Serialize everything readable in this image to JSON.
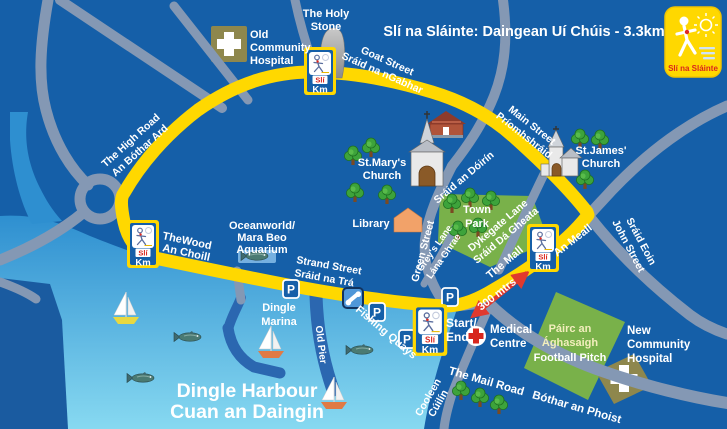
{
  "title": "Slí na Sláinte: Daingean Uí Chúis - 3.3km",
  "logo": {
    "name": "Slí na Sláinte"
  },
  "km_marker": {
    "sli": "Slí",
    "km": "Km"
  },
  "icons": {
    "parking": "P"
  },
  "scale": {
    "distance": "300 mtrs"
  },
  "colors": {
    "route_yellow": "#ffd800",
    "land_blue": "#155fa8",
    "road_gray": "#8498b4",
    "sea_top": "#2e8fd0",
    "sea_bottom": "#87d9f1",
    "arrow_red": "#e0392e",
    "park_green": "#79b14a",
    "hospital_khaki": "#8e874d"
  },
  "labels": {
    "holy_stone": {
      "l1": "The Holy",
      "l2": "Stone"
    },
    "old_hospital": {
      "l1": "Old",
      "l2": "Community",
      "l3": "Hospital"
    },
    "goat_street": {
      "l1": "Goat Street",
      "l2": "Sráid na nGabhar"
    },
    "high_road": {
      "l1": "The High Road",
      "l2": "An Bóthar Ard"
    },
    "main_street": {
      "l1": "Main Street",
      "l2": "Príomhshráid"
    },
    "st_marys": {
      "l1": "St.Mary's",
      "l2": "Church"
    },
    "st_james": {
      "l1": "St.James'",
      "l2": "Church"
    },
    "library": {
      "l1": "Library"
    },
    "town_park": {
      "l1": "Town",
      "l2": "Park"
    },
    "green_street": {
      "l1": "Green Street",
      "l2": "Sráid an Dóirín"
    },
    "greys_lane": {
      "l1": "Grey's Lane",
      "l2": "Lána Ghrae"
    },
    "dykegate_lane": {
      "l1": "Dykegate Lane",
      "l2": "Sráid Dá Gheata"
    },
    "the_mall": {
      "l1": "The Mall"
    },
    "an_meall": {
      "l1": "An Meall"
    },
    "john_street": {
      "l1": "John Street",
      "l2": "Sráid Eoin"
    },
    "the_wood": {
      "l1": "TheWood",
      "l2": "An Choill"
    },
    "oceanworld": {
      "l1": "Oceanworld/",
      "l2": "Mara Beo",
      "l3": "Aquarium"
    },
    "strand_street": {
      "l1": "Strand Street",
      "l2": "Sráid na Trá"
    },
    "dingle_marina": {
      "l1": "Dingle",
      "l2": "Marina"
    },
    "old_pier": {
      "l1": "Old Pier"
    },
    "fishing_quays": {
      "l1": "Fishing Quays"
    },
    "start_end": {
      "l1": "Start/",
      "l2": "End"
    },
    "medical_centre": {
      "l1": "Medical",
      "l2": "Centre"
    },
    "football_pitch": {
      "l1": "Páirc an",
      "l2": "Ághasaigh",
      "l3": "Football Pitch"
    },
    "new_hospital": {
      "l1": "New",
      "l2": "Community",
      "l3": "Hospital"
    },
    "mail_road": {
      "l1": "The Mail Road",
      "l2": "Bóthar an Phoist"
    },
    "cooleen": {
      "l1": "Cooleen",
      "l2": "Cúilín"
    },
    "harbour": {
      "l1": "Dingle Harbour",
      "l2": "Cuan an Daingin"
    }
  }
}
